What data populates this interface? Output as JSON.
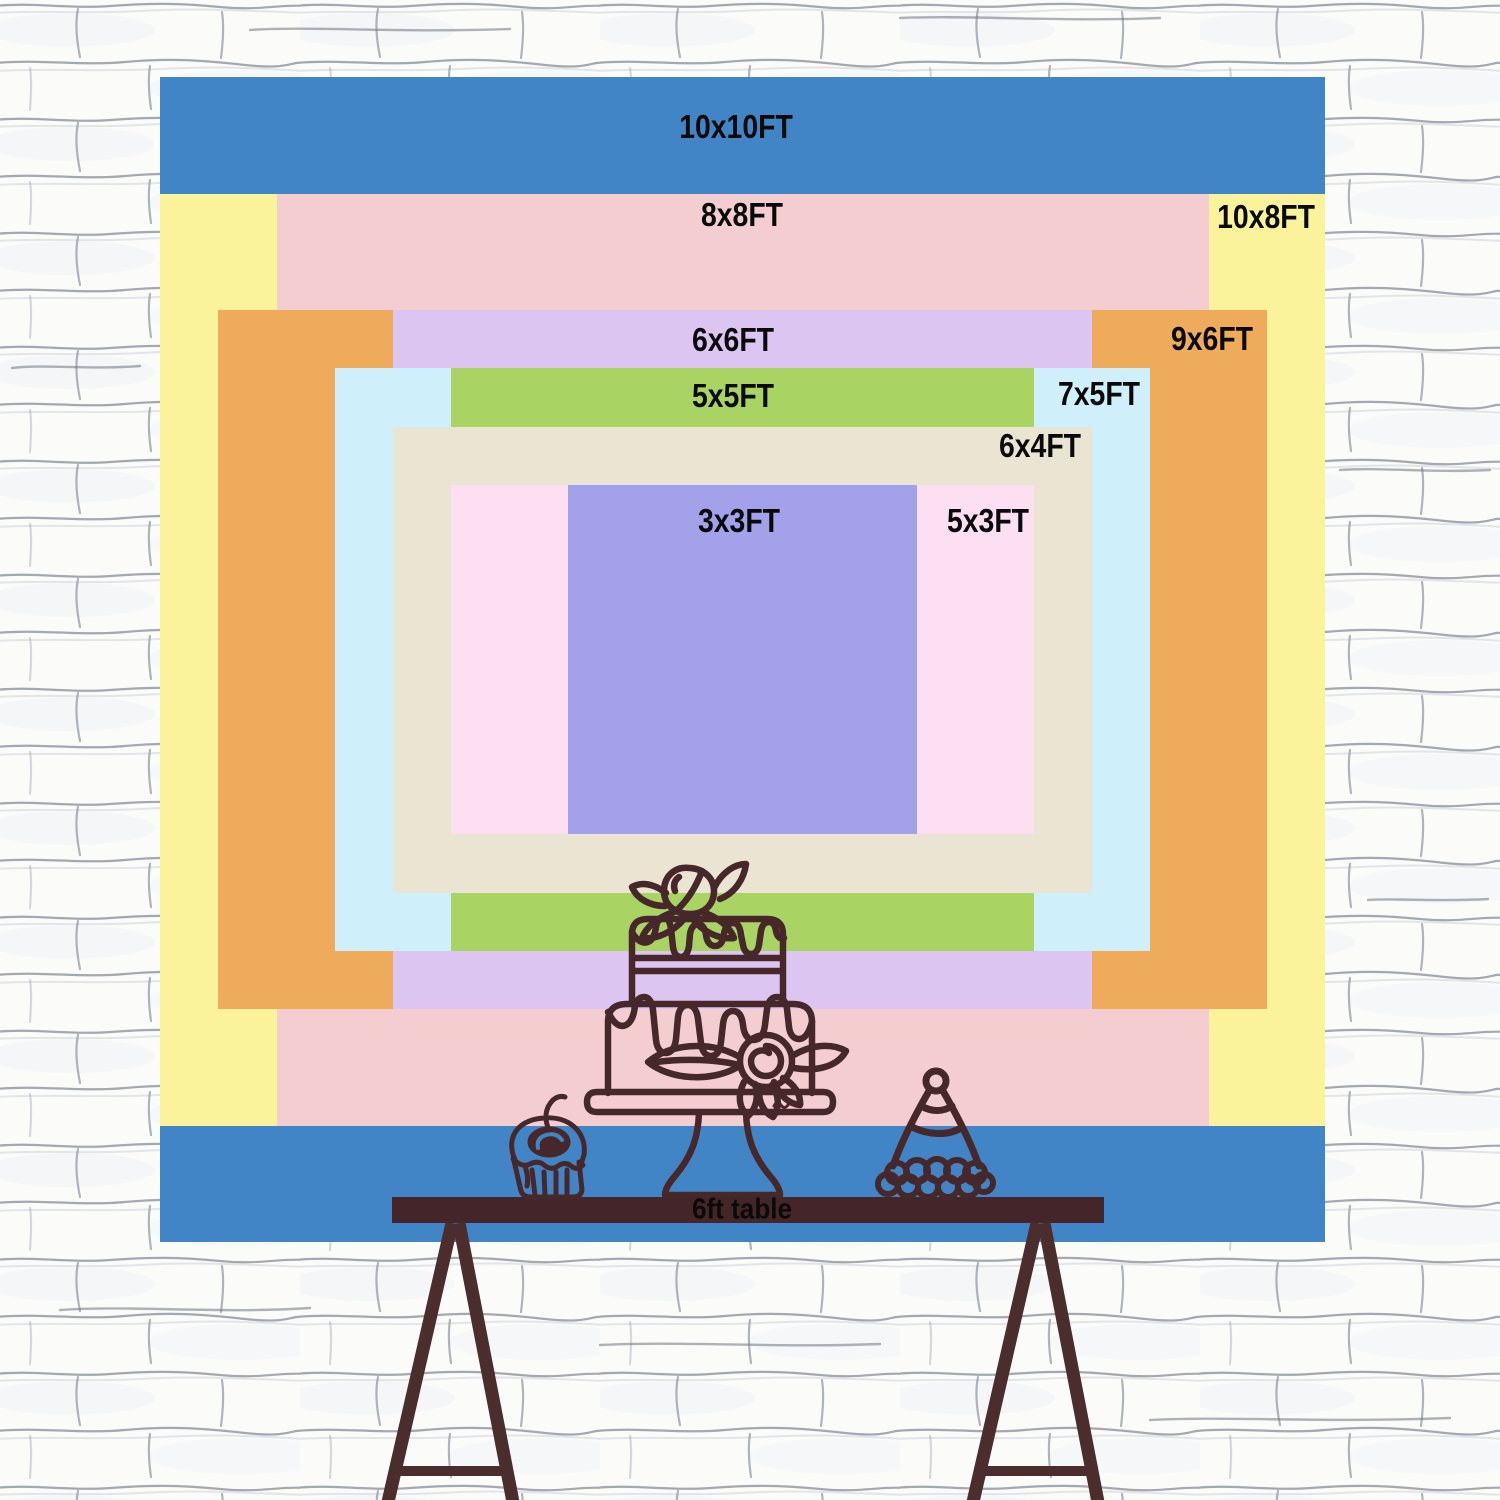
{
  "chart_data": {
    "type": "table",
    "title": "Backdrop size comparison chart",
    "sizes": [
      {
        "label": "10x10FT",
        "width_ft": 10,
        "height_ft": 10,
        "color": "#4185c6"
      },
      {
        "label": "10x8FT",
        "width_ft": 10,
        "height_ft": 8,
        "color": "#fbf29c"
      },
      {
        "label": "8x8FT",
        "width_ft": 8,
        "height_ft": 8,
        "color": "#f4cdd0"
      },
      {
        "label": "9x6FT",
        "width_ft": 9,
        "height_ft": 6,
        "color": "#eeab5c"
      },
      {
        "label": "6x6FT",
        "width_ft": 6,
        "height_ft": 6,
        "color": "#dcc5f1"
      },
      {
        "label": "7x5FT",
        "width_ft": 7,
        "height_ft": 5,
        "color": "#cfeffa"
      },
      {
        "label": "5x5FT",
        "width_ft": 5,
        "height_ft": 5,
        "color": "#a9d464"
      },
      {
        "label": "6x4FT",
        "width_ft": 6,
        "height_ft": 4,
        "color": "#eae5d3"
      },
      {
        "label": "5x3FT",
        "width_ft": 5,
        "height_ft": 3,
        "color": "#fddff2"
      },
      {
        "label": "3x3FT",
        "width_ft": 3,
        "height_ft": 3,
        "color": "#a2a1e9"
      }
    ]
  },
  "table": {
    "label": "6ft table"
  },
  "icons": [
    {
      "name": "cake-icon"
    },
    {
      "name": "cupcake-icon"
    },
    {
      "name": "party-hat-icon"
    }
  ],
  "palette": {
    "line_art": "#46282a",
    "table_top": "#44262a",
    "table_legs": "#4b2d2e",
    "label_text": "#0a0a0a",
    "wall_base": "#fbfbfa",
    "wall_mortar": "#7e8490",
    "cherry_highlight": "#4185c6"
  }
}
